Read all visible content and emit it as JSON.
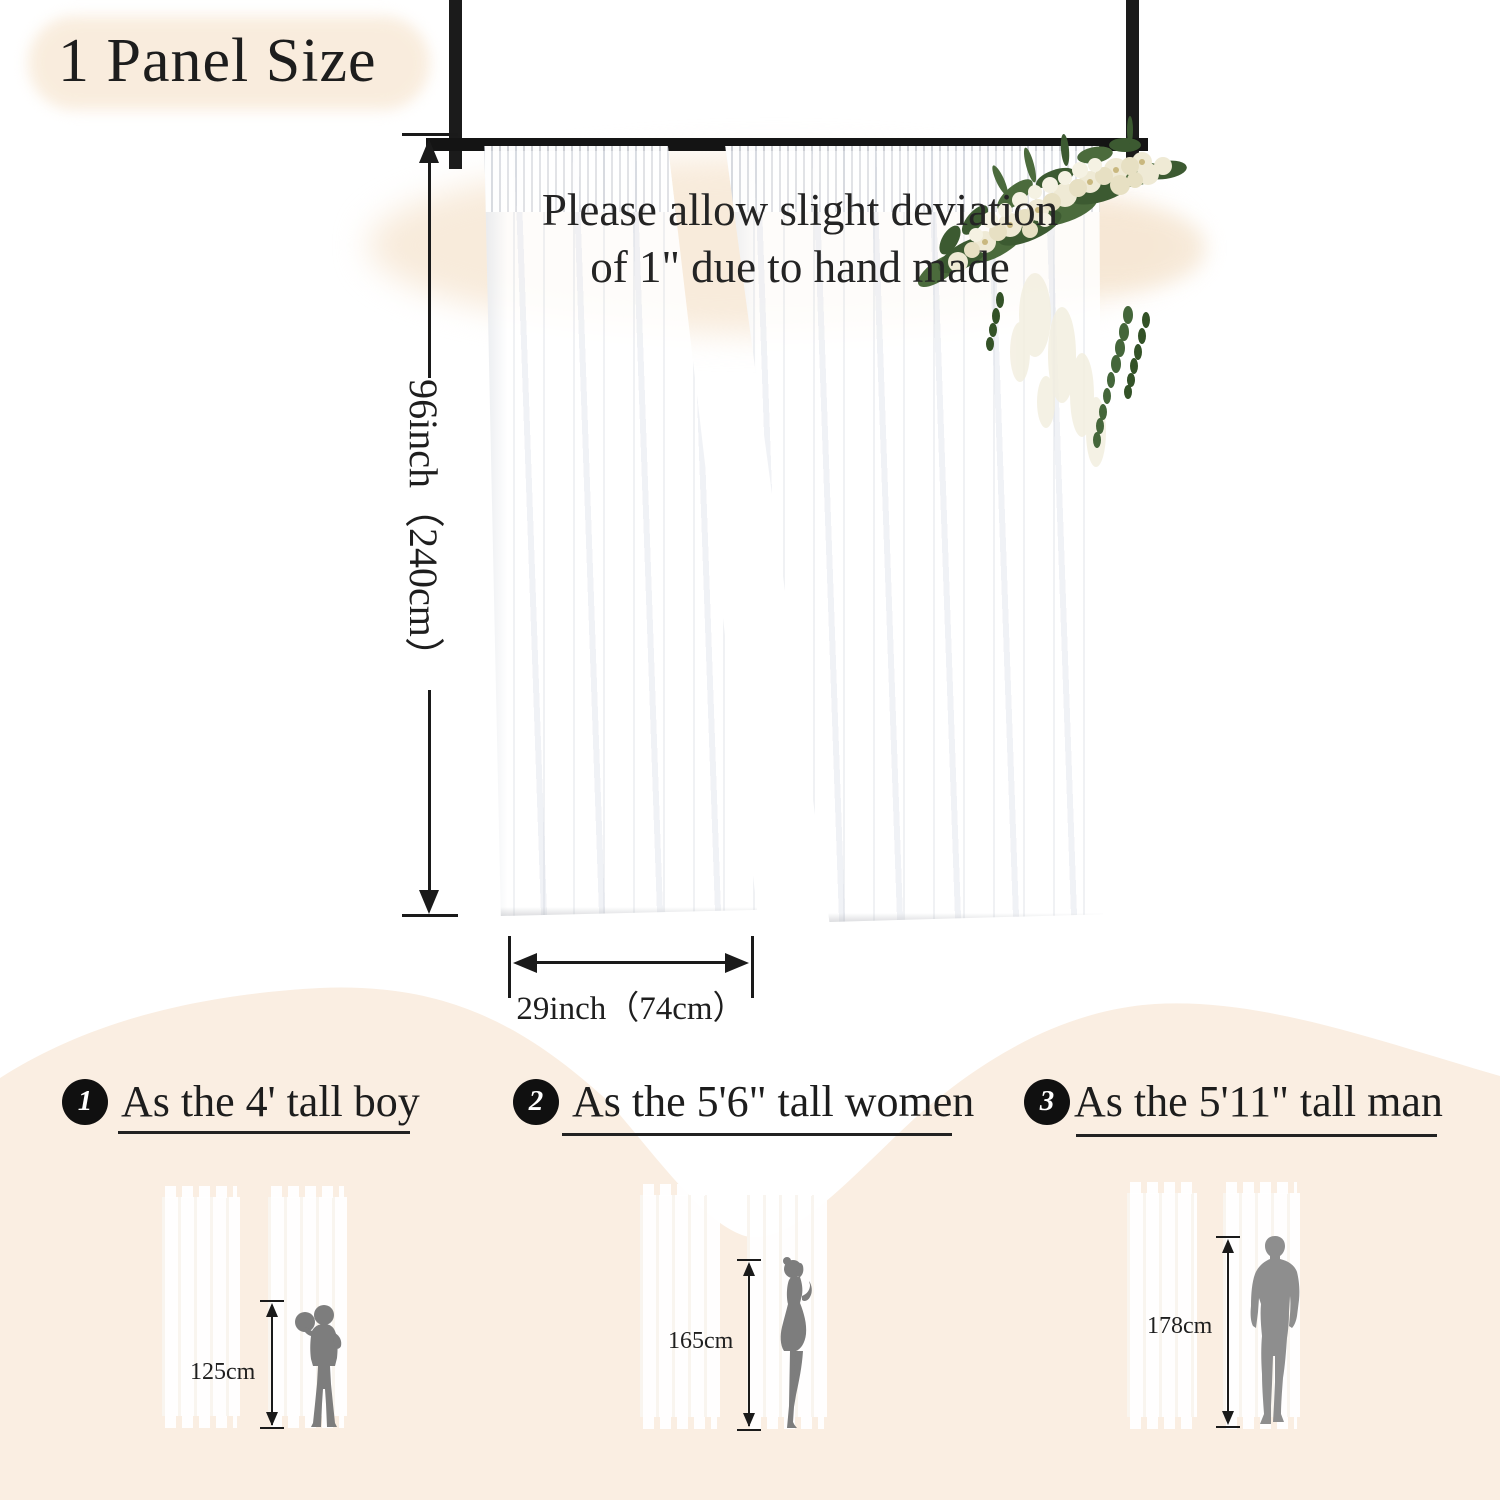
{
  "title": "1 Panel Size",
  "note": {
    "line1": "Please allow slight deviation",
    "line2": "of 1\" due to hand made"
  },
  "panel_dimensions": {
    "height": "96inch（240cm）",
    "width": "29inch（74cm）"
  },
  "comparisons": [
    {
      "number": "1",
      "label": "As the 4' tall boy",
      "figure": "boy",
      "height_label": "125cm"
    },
    {
      "number": "2",
      "label": "As the 5'6\" tall women",
      "figure": "woman",
      "height_label": "165cm"
    },
    {
      "number": "3",
      "label": "As the 5'11\" tall man",
      "figure": "man",
      "height_label": "178cm"
    }
  ],
  "colors": {
    "background": "#ffffff",
    "cream_blob": "#f8ebdb",
    "bottom_band": "#faeee2",
    "frame_black": "#1a1a1a",
    "text": "#222222",
    "silhouette_gray": "#7d7d7d",
    "man_gray": "#8e8e8e",
    "leaf_green": "#4b6b3c",
    "flower_ivory": "#efead5"
  },
  "icons": {
    "curtain-rod": "black horizontal bar",
    "rod-post": "black vertical bar",
    "height-arrow": "double-headed vertical arrow with end ticks",
    "width-arrow": "double-headed horizontal arrow with end ticks",
    "floral-arrangement": "ivory flowers with greenery",
    "boy-silhouette": "gray boy holding ball",
    "woman-silhouette": "gray standing woman",
    "man-silhouette": "gray standing man in suit",
    "numbered-badge": "white digit in black circle"
  }
}
